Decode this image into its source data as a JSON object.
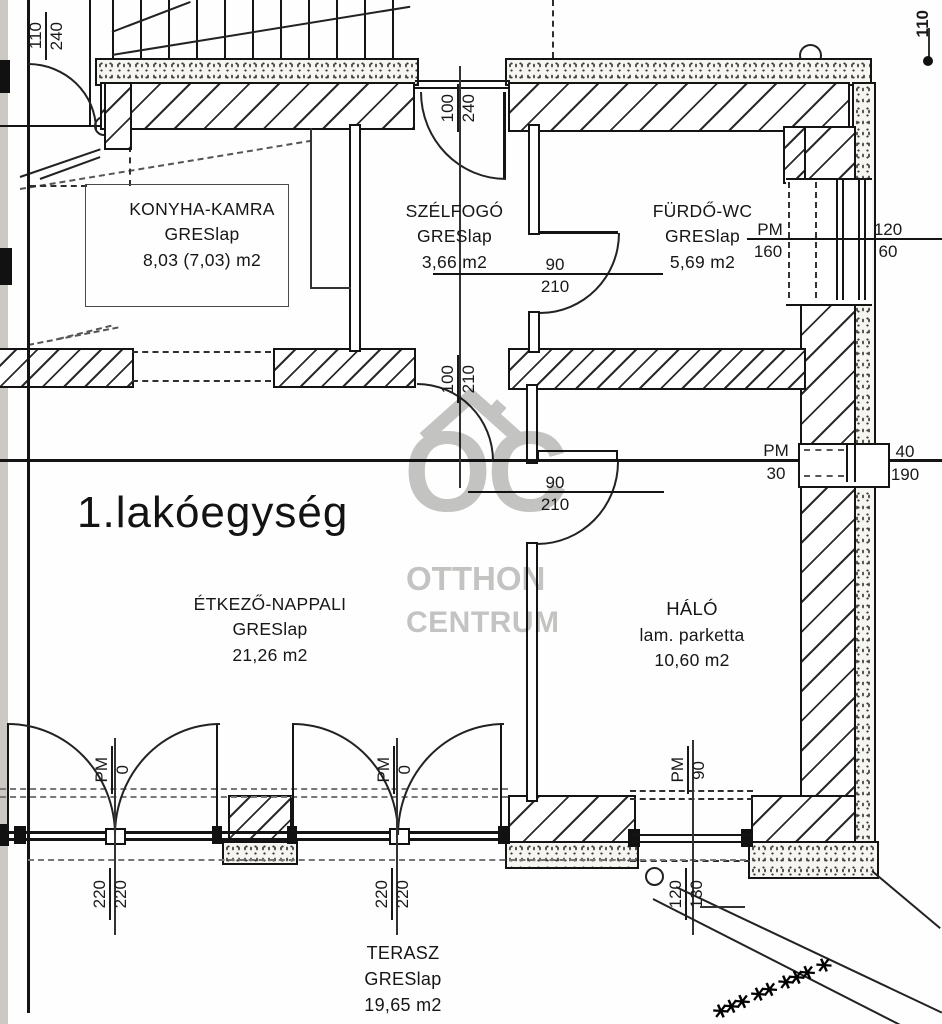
{
  "unit_label": "1.lakóegység",
  "rooms": {
    "konyha": {
      "name": "KONYHA-KAMRA",
      "floor": "GRESlap",
      "area": "8,03 (7,03) m2"
    },
    "szelfogo": {
      "name": "SZÉLFOGÓ",
      "floor": "GRESlap",
      "area": "3,66 m2"
    },
    "furdo": {
      "name": "FÜRDŐ-WC",
      "floor": "GRESlap",
      "area": "5,69 m2"
    },
    "etkezo": {
      "name": "ÉTKEZŐ-NAPPALI",
      "floor": "GRESlap",
      "area": "21,26 m2"
    },
    "halo": {
      "name": "HÁLÓ",
      "floor": "lam. parketta",
      "area": "10,60 m2"
    },
    "terasz": {
      "name": "TERASZ",
      "floor": "GRESlap",
      "area": "19,65 m2"
    }
  },
  "dims": {
    "stair_door": {
      "w": "110",
      "h": "240"
    },
    "entry_door": {
      "w": "100",
      "h": "240"
    },
    "szelfogo_door": {
      "w": "100",
      "h": "210"
    },
    "bath_door": {
      "w": "90",
      "h": "210"
    },
    "halo_door": {
      "w": "90",
      "h": "210"
    },
    "top_right": "110",
    "bath_window": {
      "pm": "PM",
      "pm_v": "160",
      "w": "120",
      "h": "60"
    },
    "small_window": {
      "pm": "PM",
      "pm_v": "30",
      "w": "40",
      "h": "190"
    },
    "halo_window": {
      "pm": "PM",
      "pm_v": "90",
      "w": "120",
      "h": "130"
    },
    "terrace_door_1": {
      "pm": "PM",
      "pm_v": "0",
      "w": "220",
      "h": "220"
    },
    "terrace_door_2": {
      "pm": "PM",
      "pm_v": "0",
      "w": "220",
      "h": "220"
    }
  },
  "watermark": {
    "monogram": "OC",
    "line1": "OTTHON",
    "line2": "CENTRUM"
  },
  "decor": {
    "shrubs": "*** ** *** *"
  },
  "colors": {
    "line": "#1a1a1a",
    "watermark": "#9f9f9e",
    "paper": "#ffffff"
  }
}
